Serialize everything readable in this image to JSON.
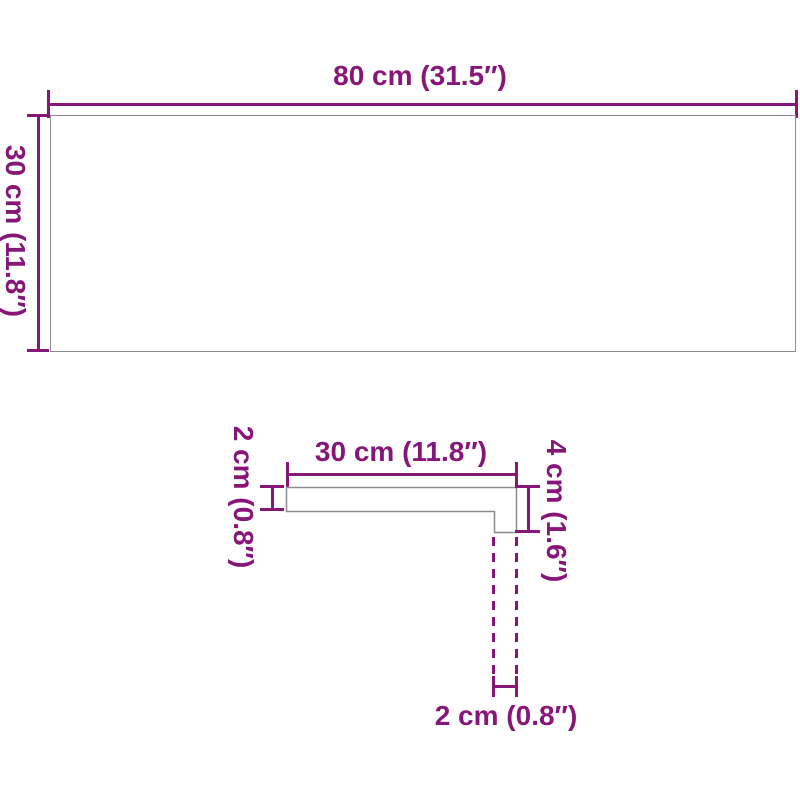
{
  "diagram": {
    "type": "product-dimension-diagram",
    "colors": {
      "dimension_accent": "#871679",
      "shape_outline": "#8c8c8c",
      "background": "#ffffff"
    },
    "top_view": {
      "width_label": "80 cm (31.5″)",
      "height_label": "30 cm (11.8″)"
    },
    "profile_view": {
      "width_label": "30 cm (11.8″)",
      "thickness_label": "2 cm (0.8″)",
      "edge_height_label": "4 cm (1.6″)",
      "edge_width_label": "2 cm (0.8″)"
    }
  }
}
